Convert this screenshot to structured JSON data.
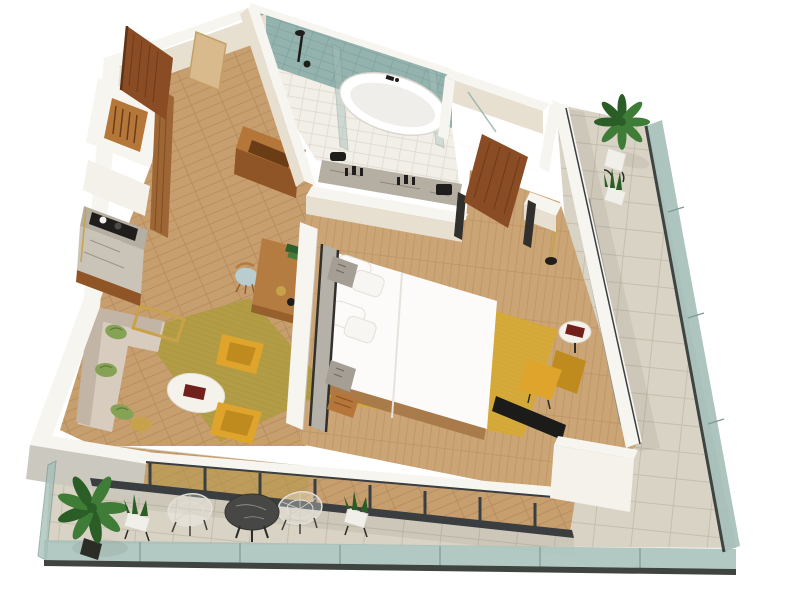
{
  "scene": {
    "kind": "isometric-3d-apartment-floor-plan-rendering",
    "rooms": [
      "entry",
      "wardrobe-closet",
      "kitchenette",
      "bathroom",
      "toilet-room",
      "living-room",
      "work-desk-area",
      "bedroom",
      "balcony-terrace"
    ],
    "furniture": [
      "entry-door",
      "entry-mat",
      "closet-hangers",
      "wardrobe-door",
      "coffee-counter",
      "open-shelf-unit",
      "rain-shower",
      "shower-glass",
      "bathtub",
      "vanity-counter",
      "bedroom-door",
      "l-shaped-sofa",
      "throw-pillows",
      "console-table",
      "coffee-table",
      "red-book",
      "armchair",
      "side-table",
      "desk",
      "desk-chair",
      "desk-lamp",
      "divider-wall",
      "bed",
      "pillows",
      "headboard",
      "nightstand",
      "luggage-bench",
      "floor-lamp",
      "round-side-table",
      "lounge-chair",
      "tv",
      "curtains",
      "window-wall",
      "glass-balustrade",
      "wire-chair",
      "terrace-table",
      "palm-plant",
      "snake-plant",
      "aloe-pot"
    ]
  },
  "colors": {
    "bg": "#ffffff",
    "wallTop": "#f7f5f0",
    "wallFace": "#e7dfd0",
    "wallGray": "#cbc8c0",
    "woodHall": "#c79e6e",
    "woodHallLine": "#b38a5c",
    "woodBedroom": "#cba575",
    "woodBedroomLine": "#bb9264",
    "woodBase": "#a97a4a",
    "rugOlive": "#b29c45",
    "rugOliveLine": "#a38c38",
    "rugMustard": "#d6aa3a",
    "rugMustardLine": "#c69a2b",
    "sofa": "#d8ccbf",
    "sofaShade": "#c3b5a6",
    "pillowGreen": "#86a355",
    "pillowDark": "#5d7b38",
    "chairYellow": "#dfa42c",
    "chairYellowDark": "#bf8a1e",
    "tableWhite": "#f5f2ec",
    "bookRed": "#71201c",
    "gold": "#c8a24a",
    "desk": "#b57c42",
    "deskDark": "#96602c",
    "chairSeat": "#b9cdd1",
    "bedWhite": "#fcfbf9",
    "bedShade": "#e6e3dc",
    "headboard": "#b6b1a8",
    "frameDark": "#32302c",
    "nightstand": "#a59e94",
    "door": "#8a4c24",
    "doorDark": "#5e3214",
    "wardrobe": "#9e6634",
    "tileTeal": "#95b3ae",
    "tileTealLine": "#7ea49e",
    "bathFloor": "#f2efe8",
    "bathFloorLine": "#ddd8cc",
    "tub": "#ffffff",
    "tubInner": "#f0eeea",
    "tubEdge": "#d9d7d0",
    "marble": "#b5aea3",
    "marbleLight": "#c9c3b8",
    "black": "#1f1e1c",
    "shelfWood": "#b5763a",
    "shelfWoodDark": "#8f5526",
    "shelfWoodInner": "#6b3d17",
    "terrace": "#d9d3c5",
    "terraceLine": "#c5beac",
    "glass": "#a4beb8",
    "glassDark": "#7d9a94",
    "rail": "#3f4440",
    "mullion": "#3a3e40",
    "curtain": "#908e89",
    "curtainDark": "#6e6c66",
    "plant": "#3e7c37",
    "plantDark": "#2b5d27",
    "pot": "#f1efe9",
    "potDark": "#2c2c27",
    "wire": "#e2dfd7",
    "tv": "#1b1b1a",
    "mat": "#d9ba8c",
    "matLine": "#c2a067",
    "counterWhite": "#f3f1ea",
    "shadow": "rgba(70,62,48,0.14)",
    "shadowSoft": "rgba(70,62,48,0.08)"
  }
}
